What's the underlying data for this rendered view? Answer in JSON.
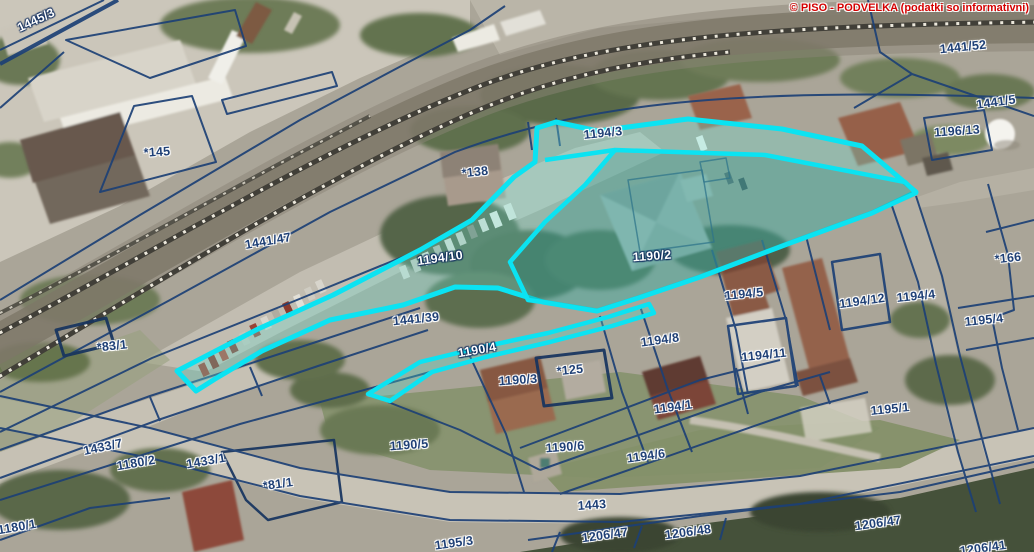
{
  "map": {
    "copyright": "© PISO - PODVELKA (podatki so informativni)"
  },
  "colors": {
    "parcel_line": "#1d4076",
    "highlight": "#0be3f2",
    "copyright_red": "#d40000",
    "label_navy": "#1f4076",
    "label_white": "#ffffff"
  },
  "selection": {
    "highlighted_parcels": [
      "1194/10",
      "1190/2",
      "1190/4"
    ]
  },
  "labels": [
    {
      "text": "1445/3",
      "x": 36,
      "y": 20,
      "rot": -25,
      "style": "white"
    },
    {
      "text": "1441/52",
      "x": 963,
      "y": 47,
      "rot": -6,
      "style": "navy"
    },
    {
      "text": "1441/5",
      "x": 996,
      "y": 102,
      "rot": -8,
      "style": "navy"
    },
    {
      "text": "1196/13",
      "x": 957,
      "y": 131,
      "rot": -4,
      "style": "navy"
    },
    {
      "text": "1194/3",
      "x": 603,
      "y": 133,
      "rot": -6,
      "style": "navy"
    },
    {
      "text": "*138",
      "x": 475,
      "y": 172,
      "rot": -6,
      "style": "navy"
    },
    {
      "text": "*145",
      "x": 157,
      "y": 152,
      "rot": -4,
      "style": "navy"
    },
    {
      "text": "1441/47",
      "x": 268,
      "y": 241,
      "rot": -10,
      "style": "navy"
    },
    {
      "text": "1194/10",
      "x": 440,
      "y": 258,
      "rot": -8,
      "style": "white"
    },
    {
      "text": "1190/2",
      "x": 652,
      "y": 256,
      "rot": -4,
      "style": "white"
    },
    {
      "text": "1194/5",
      "x": 744,
      "y": 294,
      "rot": -6,
      "style": "navy"
    },
    {
      "text": "1194/12",
      "x": 862,
      "y": 301,
      "rot": -8,
      "style": "navy"
    },
    {
      "text": "1194/4",
      "x": 916,
      "y": 296,
      "rot": -6,
      "style": "navy"
    },
    {
      "text": "*166",
      "x": 1008,
      "y": 258,
      "rot": -6,
      "style": "navy"
    },
    {
      "text": "1195/4",
      "x": 984,
      "y": 320,
      "rot": -6,
      "style": "navy"
    },
    {
      "text": "1441/39",
      "x": 416,
      "y": 319,
      "rot": -6,
      "style": "navy"
    },
    {
      "text": "*83/1",
      "x": 112,
      "y": 346,
      "rot": -6,
      "style": "navy"
    },
    {
      "text": "1194/8",
      "x": 660,
      "y": 340,
      "rot": -8,
      "style": "navy"
    },
    {
      "text": "1190/4",
      "x": 477,
      "y": 350,
      "rot": -10,
      "style": "white"
    },
    {
      "text": "1194/11",
      "x": 764,
      "y": 355,
      "rot": -6,
      "style": "navy"
    },
    {
      "text": "*125",
      "x": 570,
      "y": 370,
      "rot": -6,
      "style": "navy"
    },
    {
      "text": "1190/3",
      "x": 518,
      "y": 380,
      "rot": -4,
      "style": "navy"
    },
    {
      "text": "1194/1",
      "x": 673,
      "y": 407,
      "rot": -8,
      "style": "navy"
    },
    {
      "text": "1195/1",
      "x": 890,
      "y": 409,
      "rot": -6,
      "style": "navy"
    },
    {
      "text": "1433/7",
      "x": 103,
      "y": 447,
      "rot": -12,
      "style": "navy"
    },
    {
      "text": "1180/2",
      "x": 136,
      "y": 463,
      "rot": -10,
      "style": "navy"
    },
    {
      "text": "1433/1",
      "x": 206,
      "y": 461,
      "rot": -10,
      "style": "navy"
    },
    {
      "text": "*81/1",
      "x": 278,
      "y": 484,
      "rot": -8,
      "style": "navy"
    },
    {
      "text": "1190/5",
      "x": 409,
      "y": 445,
      "rot": -4,
      "style": "navy"
    },
    {
      "text": "1190/6",
      "x": 565,
      "y": 447,
      "rot": -4,
      "style": "navy"
    },
    {
      "text": "1194/6",
      "x": 646,
      "y": 456,
      "rot": -8,
      "style": "navy"
    },
    {
      "text": "1443",
      "x": 592,
      "y": 505,
      "rot": -4,
      "style": "navy"
    },
    {
      "text": "1180/1",
      "x": 17,
      "y": 527,
      "rot": -10,
      "style": "navy"
    },
    {
      "text": "1195/3",
      "x": 454,
      "y": 543,
      "rot": -8,
      "style": "navy"
    },
    {
      "text": "1206/47",
      "x": 605,
      "y": 535,
      "rot": -8,
      "style": "navy"
    },
    {
      "text": "1206/48",
      "x": 688,
      "y": 532,
      "rot": -8,
      "style": "navy"
    },
    {
      "text": "1206/47",
      "x": 878,
      "y": 523,
      "rot": -8,
      "style": "navy"
    },
    {
      "text": "1206/41",
      "x": 983,
      "y": 548,
      "rot": -8,
      "style": "navy"
    }
  ]
}
